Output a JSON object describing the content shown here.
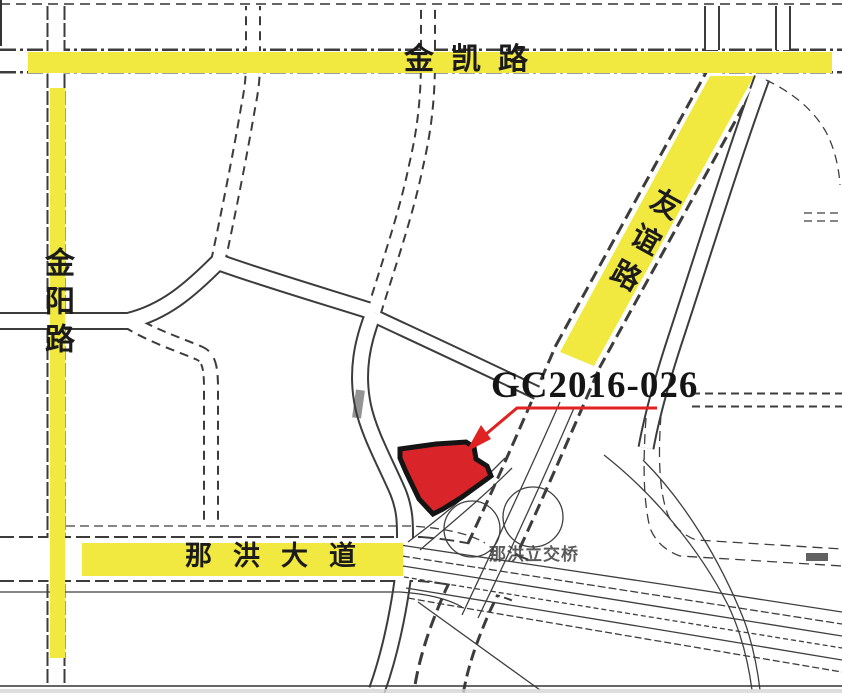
{
  "region_map": {
    "parcel": {
      "label": "GC2016-026",
      "fill_color": "#d9252a",
      "outline_color": "#141414"
    },
    "roads": {
      "top_road": "金凯路",
      "left_road": "金阳路",
      "diagonal_road": "友谊路",
      "bottom_road": "那洪大道",
      "highlight_color": "#f1e93f"
    },
    "annotations": {
      "interchange_label": "那洪立交桥"
    },
    "colors": {
      "leader_line": "#e02222",
      "road_line": "#3c3c3c",
      "background": "#ffffff"
    }
  }
}
